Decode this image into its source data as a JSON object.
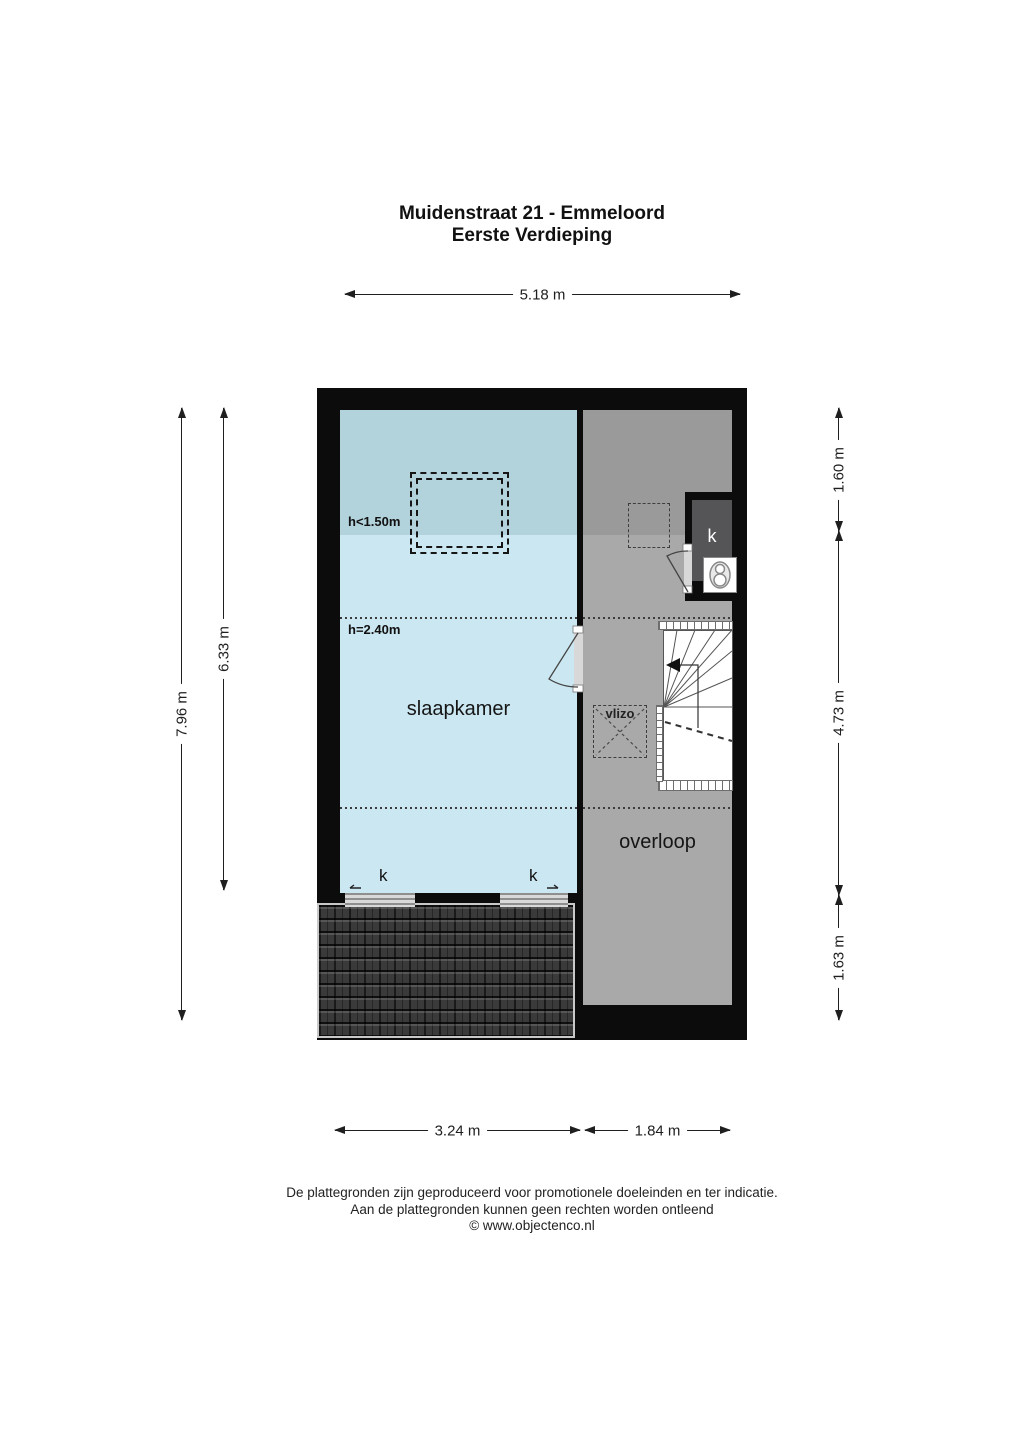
{
  "title": {
    "line1": "Muidenstraat 21 - Emmeloord",
    "line2": "Eerste Verdieping"
  },
  "dimensions": {
    "top_width": "5.18 m",
    "left_outer": "7.96 m",
    "left_inner": "6.33 m",
    "right_top": "1.60 m",
    "right_middle": "4.73 m",
    "right_bottom": "1.63 m",
    "bottom_left": "3.24 m",
    "bottom_right": "1.84 m"
  },
  "rooms": {
    "bedroom": {
      "label": "slaapkamer",
      "height_low": "h<1.50m",
      "height_main": "h=2.40m",
      "window_left_label": "k",
      "window_right_label": "k"
    },
    "landing": {
      "label": "overloop",
      "closet_label": "k",
      "hatch_label": "vlizo"
    }
  },
  "footer": {
    "line1": "De plattegronden zijn geproduceerd voor promotionele doeleinden en ter indicatie.",
    "line2": "Aan de plattegronden kunnen geen rechten worden ontleend",
    "line3": "© www.objectenco.nl"
  },
  "colors": {
    "wall": "#0c0c0c",
    "bedroom": "#cbe7f1",
    "bedroom_low": "#b2d2dc",
    "landing": "#a9a9a9",
    "landing_low": "#9a9a9a",
    "closet": "#555558",
    "roof": "#3a3a3a",
    "dim": "#1f1f1f",
    "opening": "#d8d8d8"
  }
}
